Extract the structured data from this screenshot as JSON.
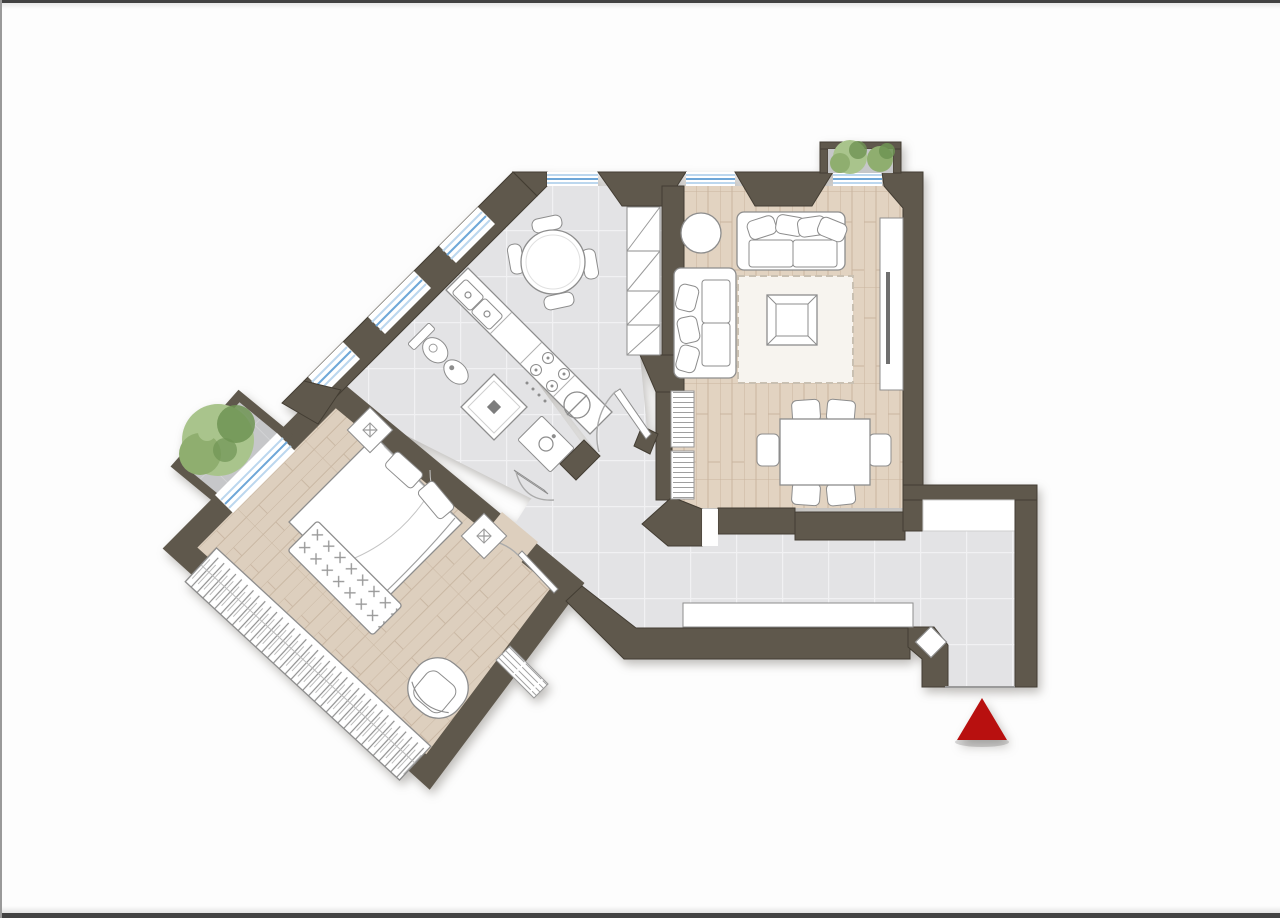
{
  "document": {
    "kind": "apartment-floor-plan-rendering",
    "visible_text": [],
    "orientation_note": "right wing axis-aligned, left wing rotated 45 degrees"
  },
  "colors": {
    "wall": "#5f584c",
    "wallStroke": "#433d33",
    "wood": "#e2d3c1",
    "woodB": "#ddcfbe",
    "woodLine": "#b49b7e",
    "tile": "#e3e3e5",
    "tileLine": "#f1f1f3",
    "balcony": "#c6c7c9",
    "balconyLine": "#d5d6d8",
    "furn": "#ffffff",
    "furnStroke": "#8d8d8d",
    "rug": "#f7f4ef",
    "blue": "#6ea7d8",
    "blueLight": "#bcd7ee",
    "red": "#b8100f",
    "green1": "#8fae6f",
    "green2": "#a9c48c",
    "green3": "#6f9454",
    "edge": "#424242"
  },
  "plan": {
    "rooms": [
      {
        "name": "living-room",
        "floor": "parquet",
        "furniture": [
          "three-seat-sofa",
          "two-seat-sofa",
          "round-side-table",
          "area-rug",
          "square-coffee-table",
          "tv-sideboard",
          "television",
          "radiator",
          "dining-table",
          "six-dining-chairs"
        ]
      },
      {
        "name": "kitchen-dining",
        "floor": "tile",
        "furniture": [
          "round-table",
          "four-chairs",
          "tall-cabinet-column",
          "counter-with-double-sink",
          "cooktop-4-burners",
          "washing-machine"
        ]
      },
      {
        "name": "bathroom",
        "floor": "tile",
        "furniture": [
          "toilet",
          "bidet",
          "shower-tray",
          "washbasin-cabinet"
        ]
      },
      {
        "name": "bedroom",
        "floor": "parquet-diagonal",
        "furniture": [
          "double-bed",
          "two-nightstands",
          "foot-bench",
          "wardrobe",
          "armchair",
          "radiator-niche"
        ]
      },
      {
        "name": "entrance-hall",
        "floor": "tile",
        "furniture": [
          "long-sideboard"
        ]
      },
      {
        "name": "bedroom-balcony",
        "floor": "stone",
        "furniture": [
          "tree"
        ]
      },
      {
        "name": "living-room-planter",
        "floor": "stone",
        "furniture": [
          "two-shrubs"
        ]
      }
    ],
    "doors": [
      "entrance-door-open-leaf",
      "kitchen-door",
      "bathroom-door",
      "bedroom-door"
    ],
    "windows": [
      "kitchen-top-window",
      "living-window-left",
      "living-window-right",
      "facade-window-1",
      "facade-window-2",
      "bathroom-window",
      "bedroom-french-window"
    ],
    "marker": {
      "name": "entrance-marker",
      "shape": "triangle-up",
      "color": "#b8100f"
    }
  }
}
